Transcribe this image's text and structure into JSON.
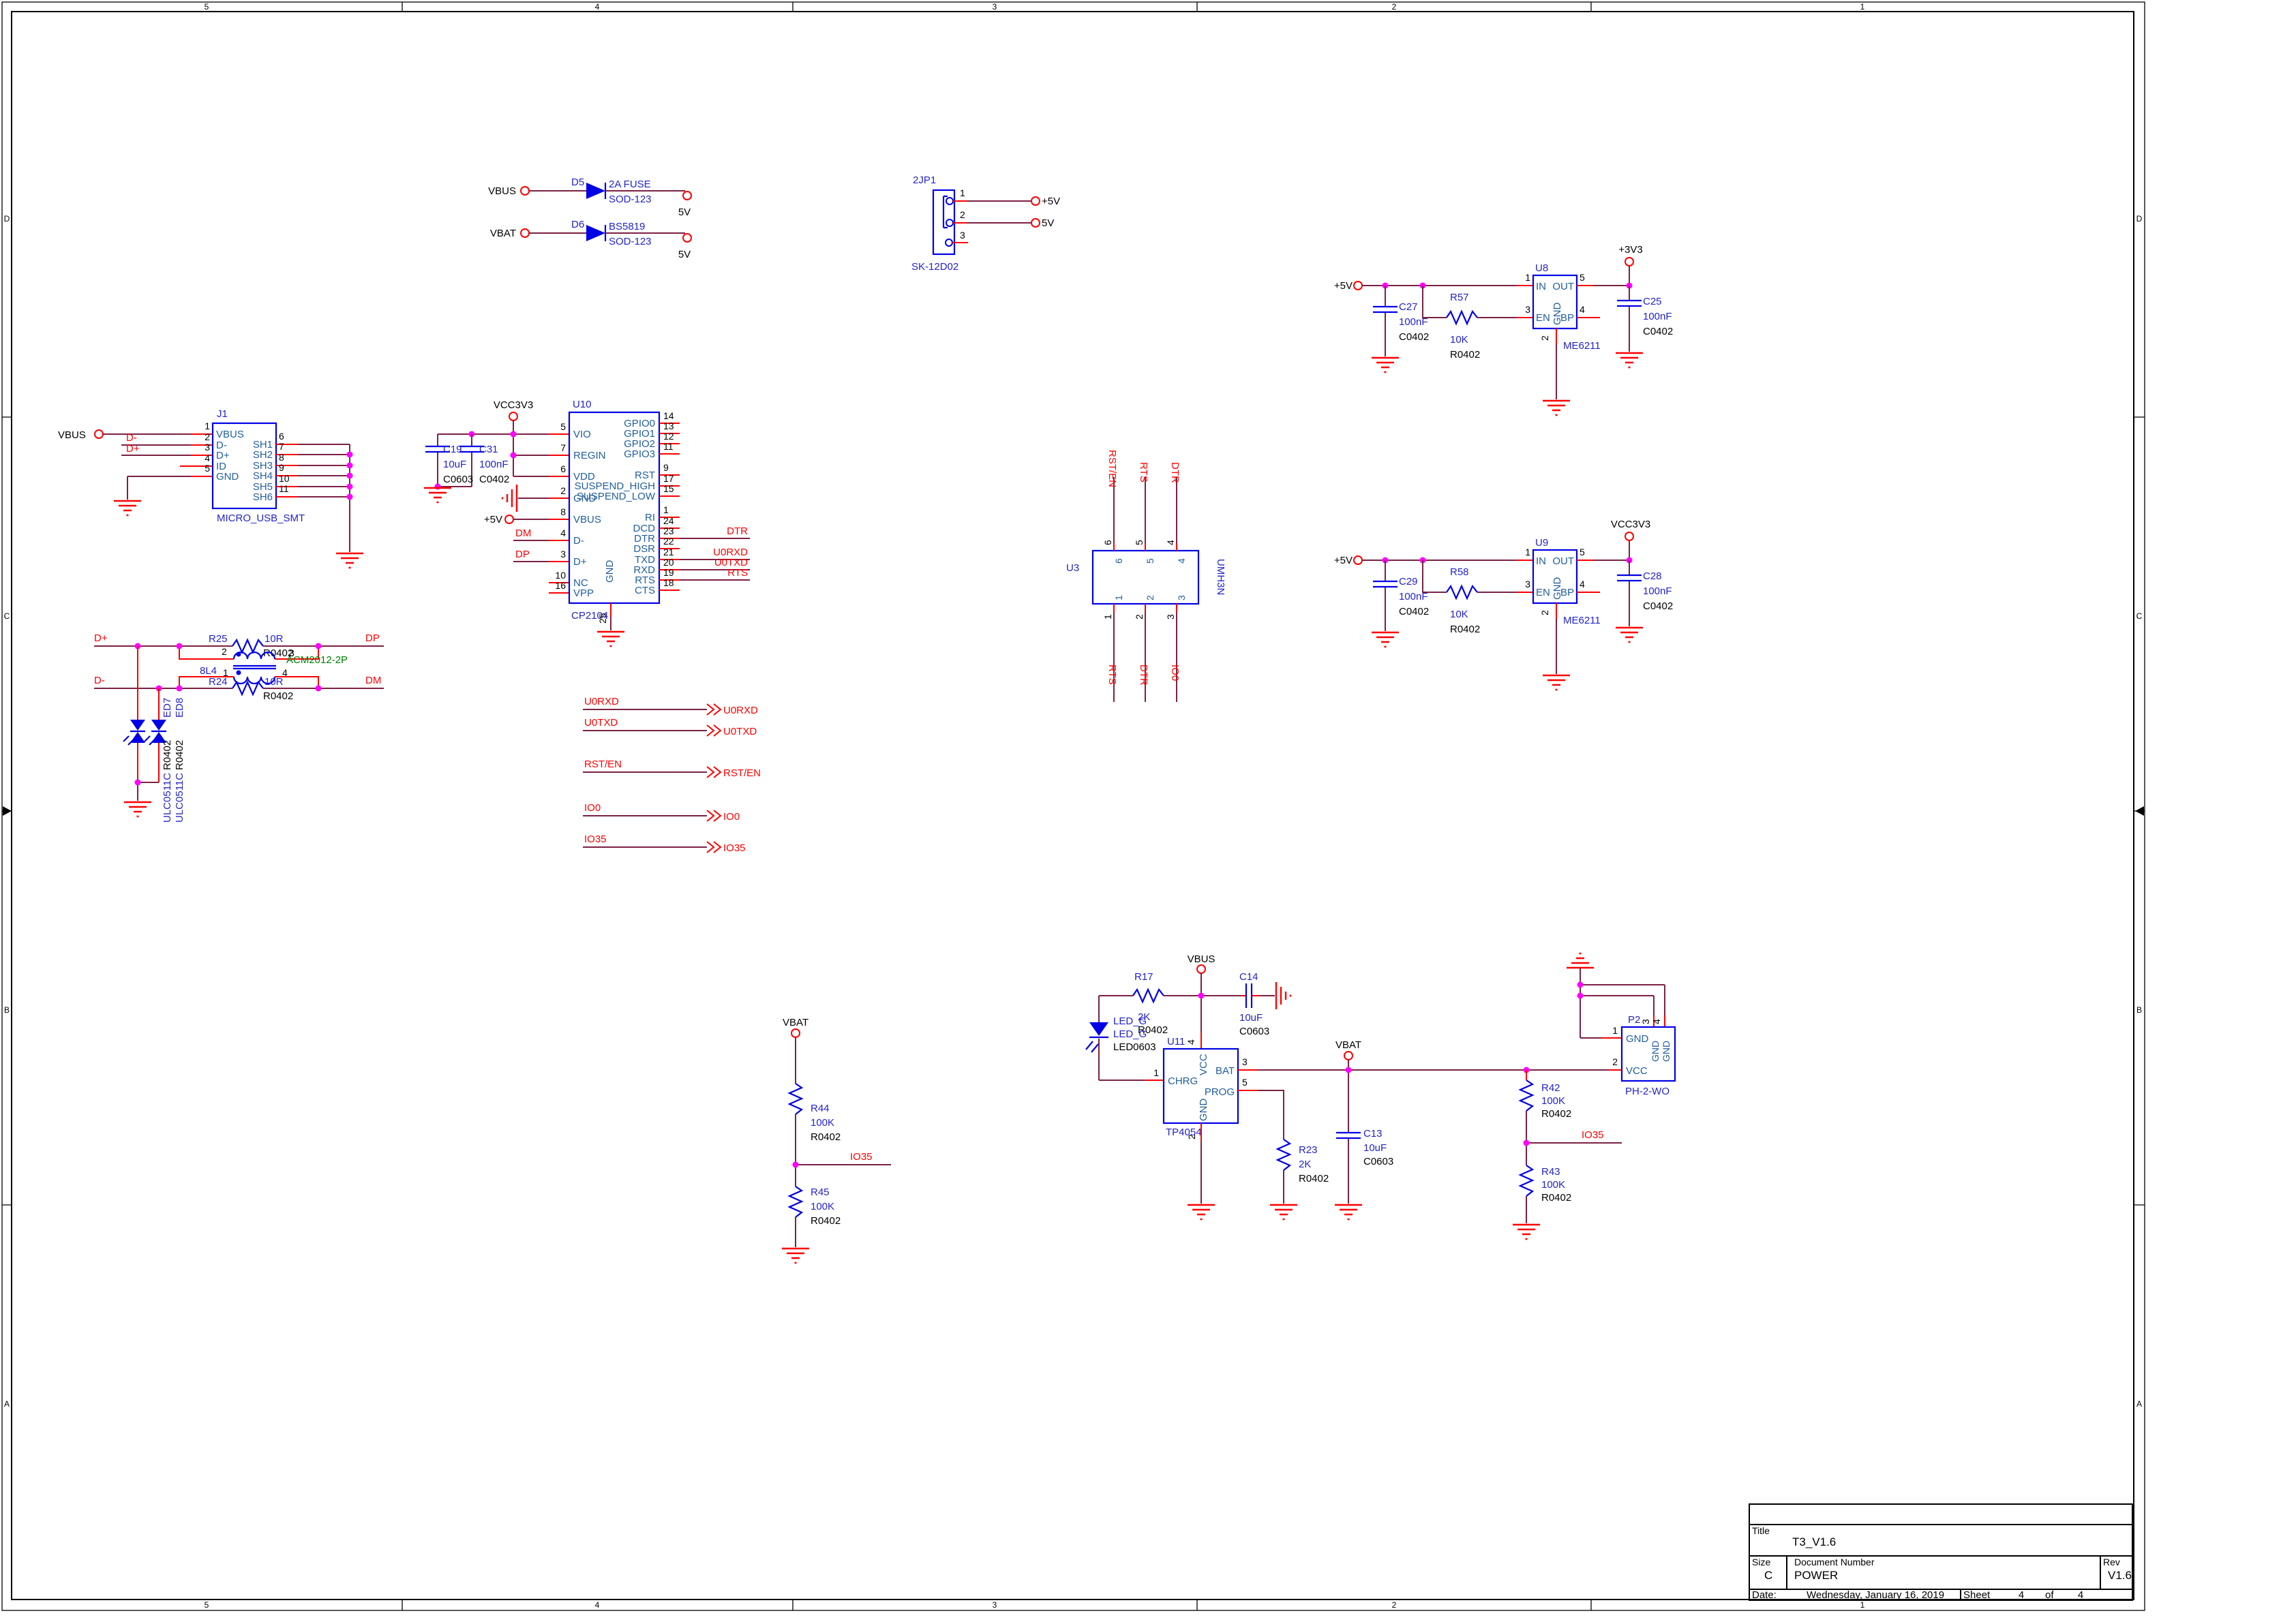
{
  "border": {
    "cols": [
      "5",
      "4",
      "3",
      "2",
      "1"
    ],
    "rows": [
      "D",
      "C",
      "B",
      "A"
    ]
  },
  "title_block": {
    "title_label": "Title",
    "title": "T3_V1.6",
    "size_label": "Size",
    "size": "C",
    "doc_label": "Document Number",
    "doc": "POWER",
    "rev_label": "Rev",
    "rev": "V1.6",
    "date_label": "Date:",
    "date": "Wednesday, January 16, 2019",
    "sheet_label": "Sheet",
    "sheet_num": "4",
    "of_label": "of",
    "sheet_total": "4"
  },
  "nets": {
    "vbus": "VBUS",
    "vbat": "VBAT",
    "p5": "+5V",
    "v5": "5V",
    "p3v3": "+3V3",
    "vcc3v3": "VCC3V3",
    "dplus": "D+",
    "dminus": "D-",
    "dp": "DP",
    "dm": "DM",
    "dtr": "DTR",
    "rts": "RTS",
    "u0rxd": "U0RXD",
    "u0txd": "U0TXD",
    "rst_en": "RST/EN",
    "io0": "IO0",
    "io35": "IO35"
  },
  "d5": {
    "ref": "D5",
    "value": "2A FUSE",
    "fp": "SOD-123"
  },
  "d6": {
    "ref": "D6",
    "value": "BS5819",
    "fp": "SOD-123"
  },
  "jp1": {
    "ref": "2JP1",
    "fp": "SK-12D02",
    "pins": [
      "1",
      "2",
      "3"
    ]
  },
  "j1": {
    "ref": "J1",
    "fp": "MICRO_USB_SMT",
    "left": [
      {
        "n": "1",
        "name": "VBUS"
      },
      {
        "n": "2",
        "name": "D-"
      },
      {
        "n": "3",
        "name": "D+"
      },
      {
        "n": "4",
        "name": "ID"
      },
      {
        "n": "5",
        "name": "GND"
      }
    ],
    "right": [
      {
        "n": "6",
        "name": "SH1"
      },
      {
        "n": "7",
        "name": "SH2"
      },
      {
        "n": "8",
        "name": "SH3"
      },
      {
        "n": "9",
        "name": "SH4"
      },
      {
        "n": "10",
        "name": "SH5"
      },
      {
        "n": "11",
        "name": "SH6"
      }
    ]
  },
  "c19": {
    "ref": "C19",
    "value": "10uF",
    "fp": "C0603"
  },
  "c31": {
    "ref": "C31",
    "value": "100nF",
    "fp": "C0402"
  },
  "u10": {
    "ref": "U10",
    "value": "CP2104",
    "left": [
      {
        "n": "5",
        "name": "VIO"
      },
      {
        "n": "7",
        "name": "REGIN"
      },
      {
        "n": "6",
        "name": "VDD"
      },
      {
        "n": "2",
        "name": "GND"
      },
      {
        "n": "8",
        "name": "VBUS"
      },
      {
        "n": "4",
        "name": "D-"
      },
      {
        "n": "3",
        "name": "D+"
      },
      {
        "n": "10",
        "name": "NC"
      },
      {
        "n": "16",
        "name": "VPP"
      }
    ],
    "right": [
      {
        "n": "14",
        "name": "GPIO0"
      },
      {
        "n": "13",
        "name": "GPIO1"
      },
      {
        "n": "12",
        "name": "GPIO2"
      },
      {
        "n": "11",
        "name": "GPIO3"
      },
      {
        "n": "9",
        "name": "RST"
      },
      {
        "n": "17",
        "name": "SUSPEND_HIGH"
      },
      {
        "n": "15",
        "name": "SUSPEND_LOW"
      },
      {
        "n": "1",
        "name": "RI"
      },
      {
        "n": "24",
        "name": "DCD"
      },
      {
        "n": "23",
        "name": "DTR"
      },
      {
        "n": "22",
        "name": "DSR"
      },
      {
        "n": "21",
        "name": "TXD"
      },
      {
        "n": "20",
        "name": "RXD"
      },
      {
        "n": "19",
        "name": "RTS"
      },
      {
        "n": "18",
        "name": "CTS"
      }
    ],
    "bottom": {
      "n": "25",
      "name": "GND"
    }
  },
  "u3": {
    "ref": "U3",
    "value": "UMH3N",
    "top": [
      "6",
      "5",
      "4"
    ],
    "bottom": [
      "1",
      "2",
      "3"
    ]
  },
  "u8": {
    "ref": "U8",
    "value": "ME6211",
    "p_in": {
      "n": "1",
      "name": "IN"
    },
    "p_en": {
      "n": "3",
      "name": "EN"
    },
    "p_gnd": {
      "n": "2",
      "name": "GND"
    },
    "p_out": {
      "n": "5",
      "name": "OUT"
    },
    "p_bp": {
      "n": "4",
      "name": "BP"
    }
  },
  "u9": {
    "ref": "U9",
    "value": "ME6211",
    "p_in": {
      "n": "1",
      "name": "IN"
    },
    "p_en": {
      "n": "3",
      "name": "EN"
    },
    "p_gnd": {
      "n": "2",
      "name": "GND"
    },
    "p_out": {
      "n": "5",
      "name": "OUT"
    },
    "p_bp": {
      "n": "4",
      "name": "BP"
    }
  },
  "c27": {
    "ref": "C27",
    "value": "100nF",
    "fp": "C0402"
  },
  "c29": {
    "ref": "C29",
    "value": "100nF",
    "fp": "C0402"
  },
  "c25": {
    "ref": "C25",
    "value": "100nF",
    "fp": "C0402"
  },
  "c28": {
    "ref": "C28",
    "value": "100nF",
    "fp": "C0402"
  },
  "r57": {
    "ref": "R57",
    "value": "10K",
    "fp": "R0402"
  },
  "r58": {
    "ref": "R58",
    "value": "10K",
    "fp": "R0402"
  },
  "r25": {
    "ref": "R25",
    "value": "10R",
    "fp": "R0402"
  },
  "r24": {
    "ref": "R24",
    "value": "10R",
    "fp": "R0402"
  },
  "l4": {
    "ref": "8L4",
    "value": "ACM2012-2P",
    "tl": "2",
    "tr": "3",
    "bl": "1",
    "br": "4"
  },
  "ed7": {
    "ref": "ED7",
    "fp": "R0402",
    "value": "ULC0511C"
  },
  "ed8": {
    "ref": "ED8",
    "fp": "R0402",
    "value": "ULC0511C"
  },
  "r44": {
    "ref": "R44",
    "value": "100K",
    "fp": "R0402"
  },
  "r45": {
    "ref": "R45",
    "value": "100K",
    "fp": "R0402"
  },
  "r17": {
    "ref": "R17",
    "value": "2K",
    "fp": "R0402"
  },
  "led": {
    "ref": "LED_G",
    "value": "LED_G",
    "fp": "LED0603"
  },
  "c14": {
    "ref": "C14",
    "value": "10uF",
    "fp": "C0603"
  },
  "u11": {
    "ref": "U11",
    "value": "TP4054",
    "p_chrg": {
      "n": "1",
      "name": "CHRG"
    },
    "p_vcc": {
      "n": "4",
      "name": "VCC"
    },
    "p_bat": {
      "n": "3",
      "name": "BAT"
    },
    "p_prog": {
      "n": "5",
      "name": "PROG"
    },
    "p_gnd": {
      "n": "2",
      "name": "GND"
    }
  },
  "r23": {
    "ref": "R23",
    "value": "2K",
    "fp": "R0402"
  },
  "c13": {
    "ref": "C13",
    "value": "10uF",
    "fp": "C0603"
  },
  "r42": {
    "ref": "R42",
    "value": "100K",
    "fp": "R0402"
  },
  "r43": {
    "ref": "R43",
    "value": "100K",
    "fp": "R0402"
  },
  "p2": {
    "ref": "P2",
    "value": "PH-2-WO",
    "p1": {
      "n": "1",
      "name": "GND"
    },
    "pv": {
      "n": "2",
      "name": "VCC"
    },
    "p3": {
      "n": "3",
      "name": "GND"
    },
    "p4": {
      "n": "4",
      "name": "GND"
    }
  }
}
